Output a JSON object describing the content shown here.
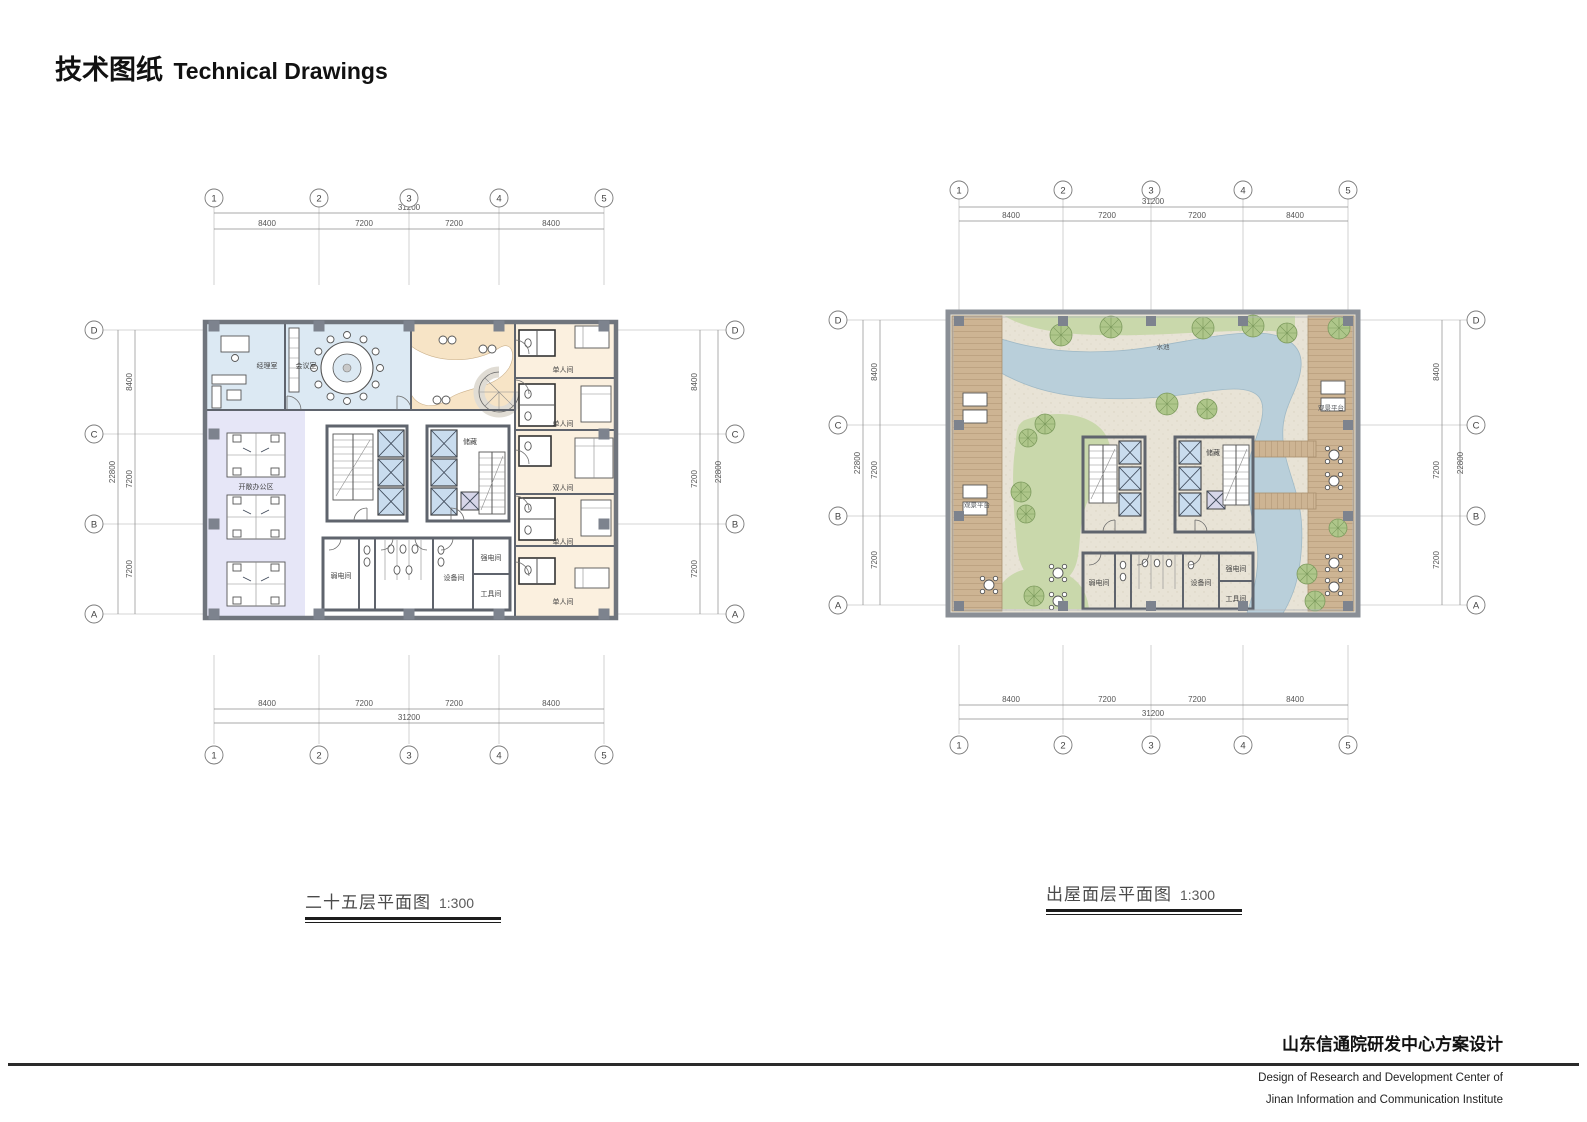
{
  "page": {
    "title_zh": "技术图纸",
    "title_en": "Technical Drawings"
  },
  "grid": {
    "cols": [
      "1",
      "2",
      "3",
      "4",
      "5"
    ],
    "rows": [
      "D",
      "C",
      "B",
      "A"
    ],
    "col_dims": [
      "8400",
      "7200",
      "7200",
      "8400"
    ],
    "col_total": "31200",
    "row_dims": [
      "8400",
      "7200",
      "7200"
    ],
    "row_total": "22800"
  },
  "plans": {
    "floor25": {
      "caption": "二十五层平面图",
      "scale": "1:300",
      "labels": {
        "manager": "经理室",
        "meeting": "会议室",
        "open_office": "开敞办公区",
        "storage": "储藏",
        "weak_power": "弱电间",
        "equipment": "设备间",
        "strong_power": "强电间",
        "tool": "工具间",
        "single": "单人间",
        "double": "双人间"
      }
    },
    "roof": {
      "caption": "出屋面层平面图",
      "scale": "1:300",
      "labels": {
        "storage": "储藏",
        "weak_power": "弱电间",
        "equipment": "设备间",
        "strong_power": "强电间",
        "tool": "工具间",
        "deck": "观景平台",
        "water": "水池"
      }
    }
  },
  "footer": {
    "project_zh": "山东信通院研发中心方案设计",
    "project_en1": "Design of Research and Development Center of",
    "project_en2": "Jinan Information and Communication Institute"
  },
  "colors": {
    "room_blue": "#dce9f3",
    "lounge_peach": "#f7e4c6",
    "office_lavender": "#e6e6f7",
    "dorm_cream": "#fbf0df",
    "service_green": "#e3efdf",
    "elevator_blue": "#c9dcee",
    "elevator_alt": "#d7d6e9",
    "roof_ground": "#e8e3d6",
    "water": "#b9cfda",
    "grass": "#c9d8ab",
    "tree": "#aec68a",
    "deck_wood": "#cdb493",
    "wall": "#5f646d",
    "column": "#7d838e"
  }
}
